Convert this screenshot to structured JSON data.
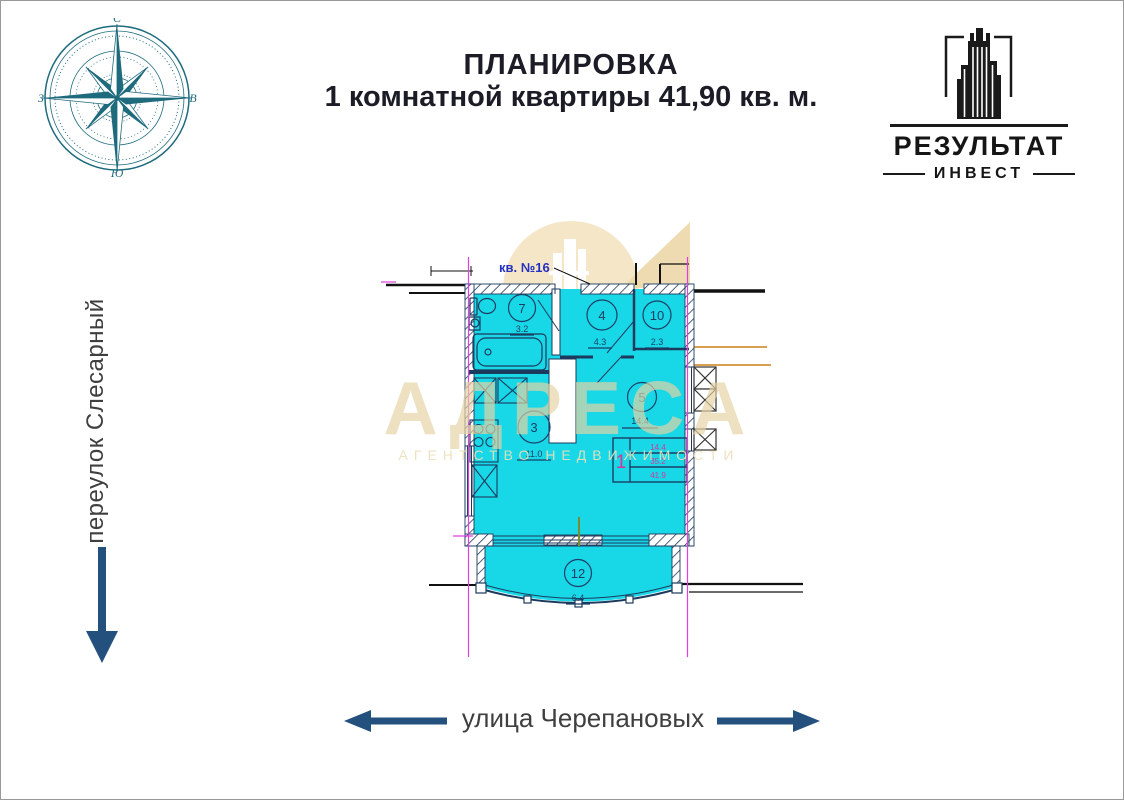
{
  "header": {
    "title_line1": "ПЛАНИРОВКА",
    "title_line2": "1 комнатной квартиры 41,90 кв. м.",
    "text_color": "#1c1c26"
  },
  "logo": {
    "company": "РЕЗУЛЬТАТ",
    "division": "ИНВЕСТ",
    "icon": "skyscraper-in-frame",
    "color": "#1a1a1a"
  },
  "compass": {
    "icon": "compass-rose",
    "color": "#1e6b7d",
    "letters": {
      "north": "С",
      "east": "В",
      "south": "Ю",
      "west": "З"
    }
  },
  "streets": {
    "left": {
      "label": "переулок Слесарный",
      "arrow_direction": "down"
    },
    "bottom": {
      "label": "улица Черепановых",
      "arrow_directions": "left-and-right"
    },
    "arrow_color": "#24507e",
    "text_color": "#3f3f3f"
  },
  "watermark": {
    "brand": "АДРЕСА",
    "tagline": "АГЕНТСТВО НЕДВИЖИМОСТИ",
    "color": "#e6d3a4",
    "logo_shapes": "circle-with-building-and-triangle"
  },
  "floor_plan": {
    "apartment_label": "кв. №16",
    "fill_color": "#18d7e6",
    "line_color": "#1c3a5e",
    "axis_color": "#e23ee2",
    "utility_line_color": "#d8a050",
    "rooms": [
      {
        "num": "7",
        "area": "3.2"
      },
      {
        "num": "4",
        "area": "4.3"
      },
      {
        "num": "10",
        "area": "2.3"
      },
      {
        "num": "3",
        "area": "11.0"
      },
      {
        "num": "5",
        "area": "14.4"
      },
      {
        "num": "12",
        "area": "6.4"
      }
    ],
    "stamp": {
      "rooms_count": "1",
      "areas": [
        "14.4",
        "35.2",
        "41.9"
      ],
      "value_color": "#d6369b"
    }
  }
}
